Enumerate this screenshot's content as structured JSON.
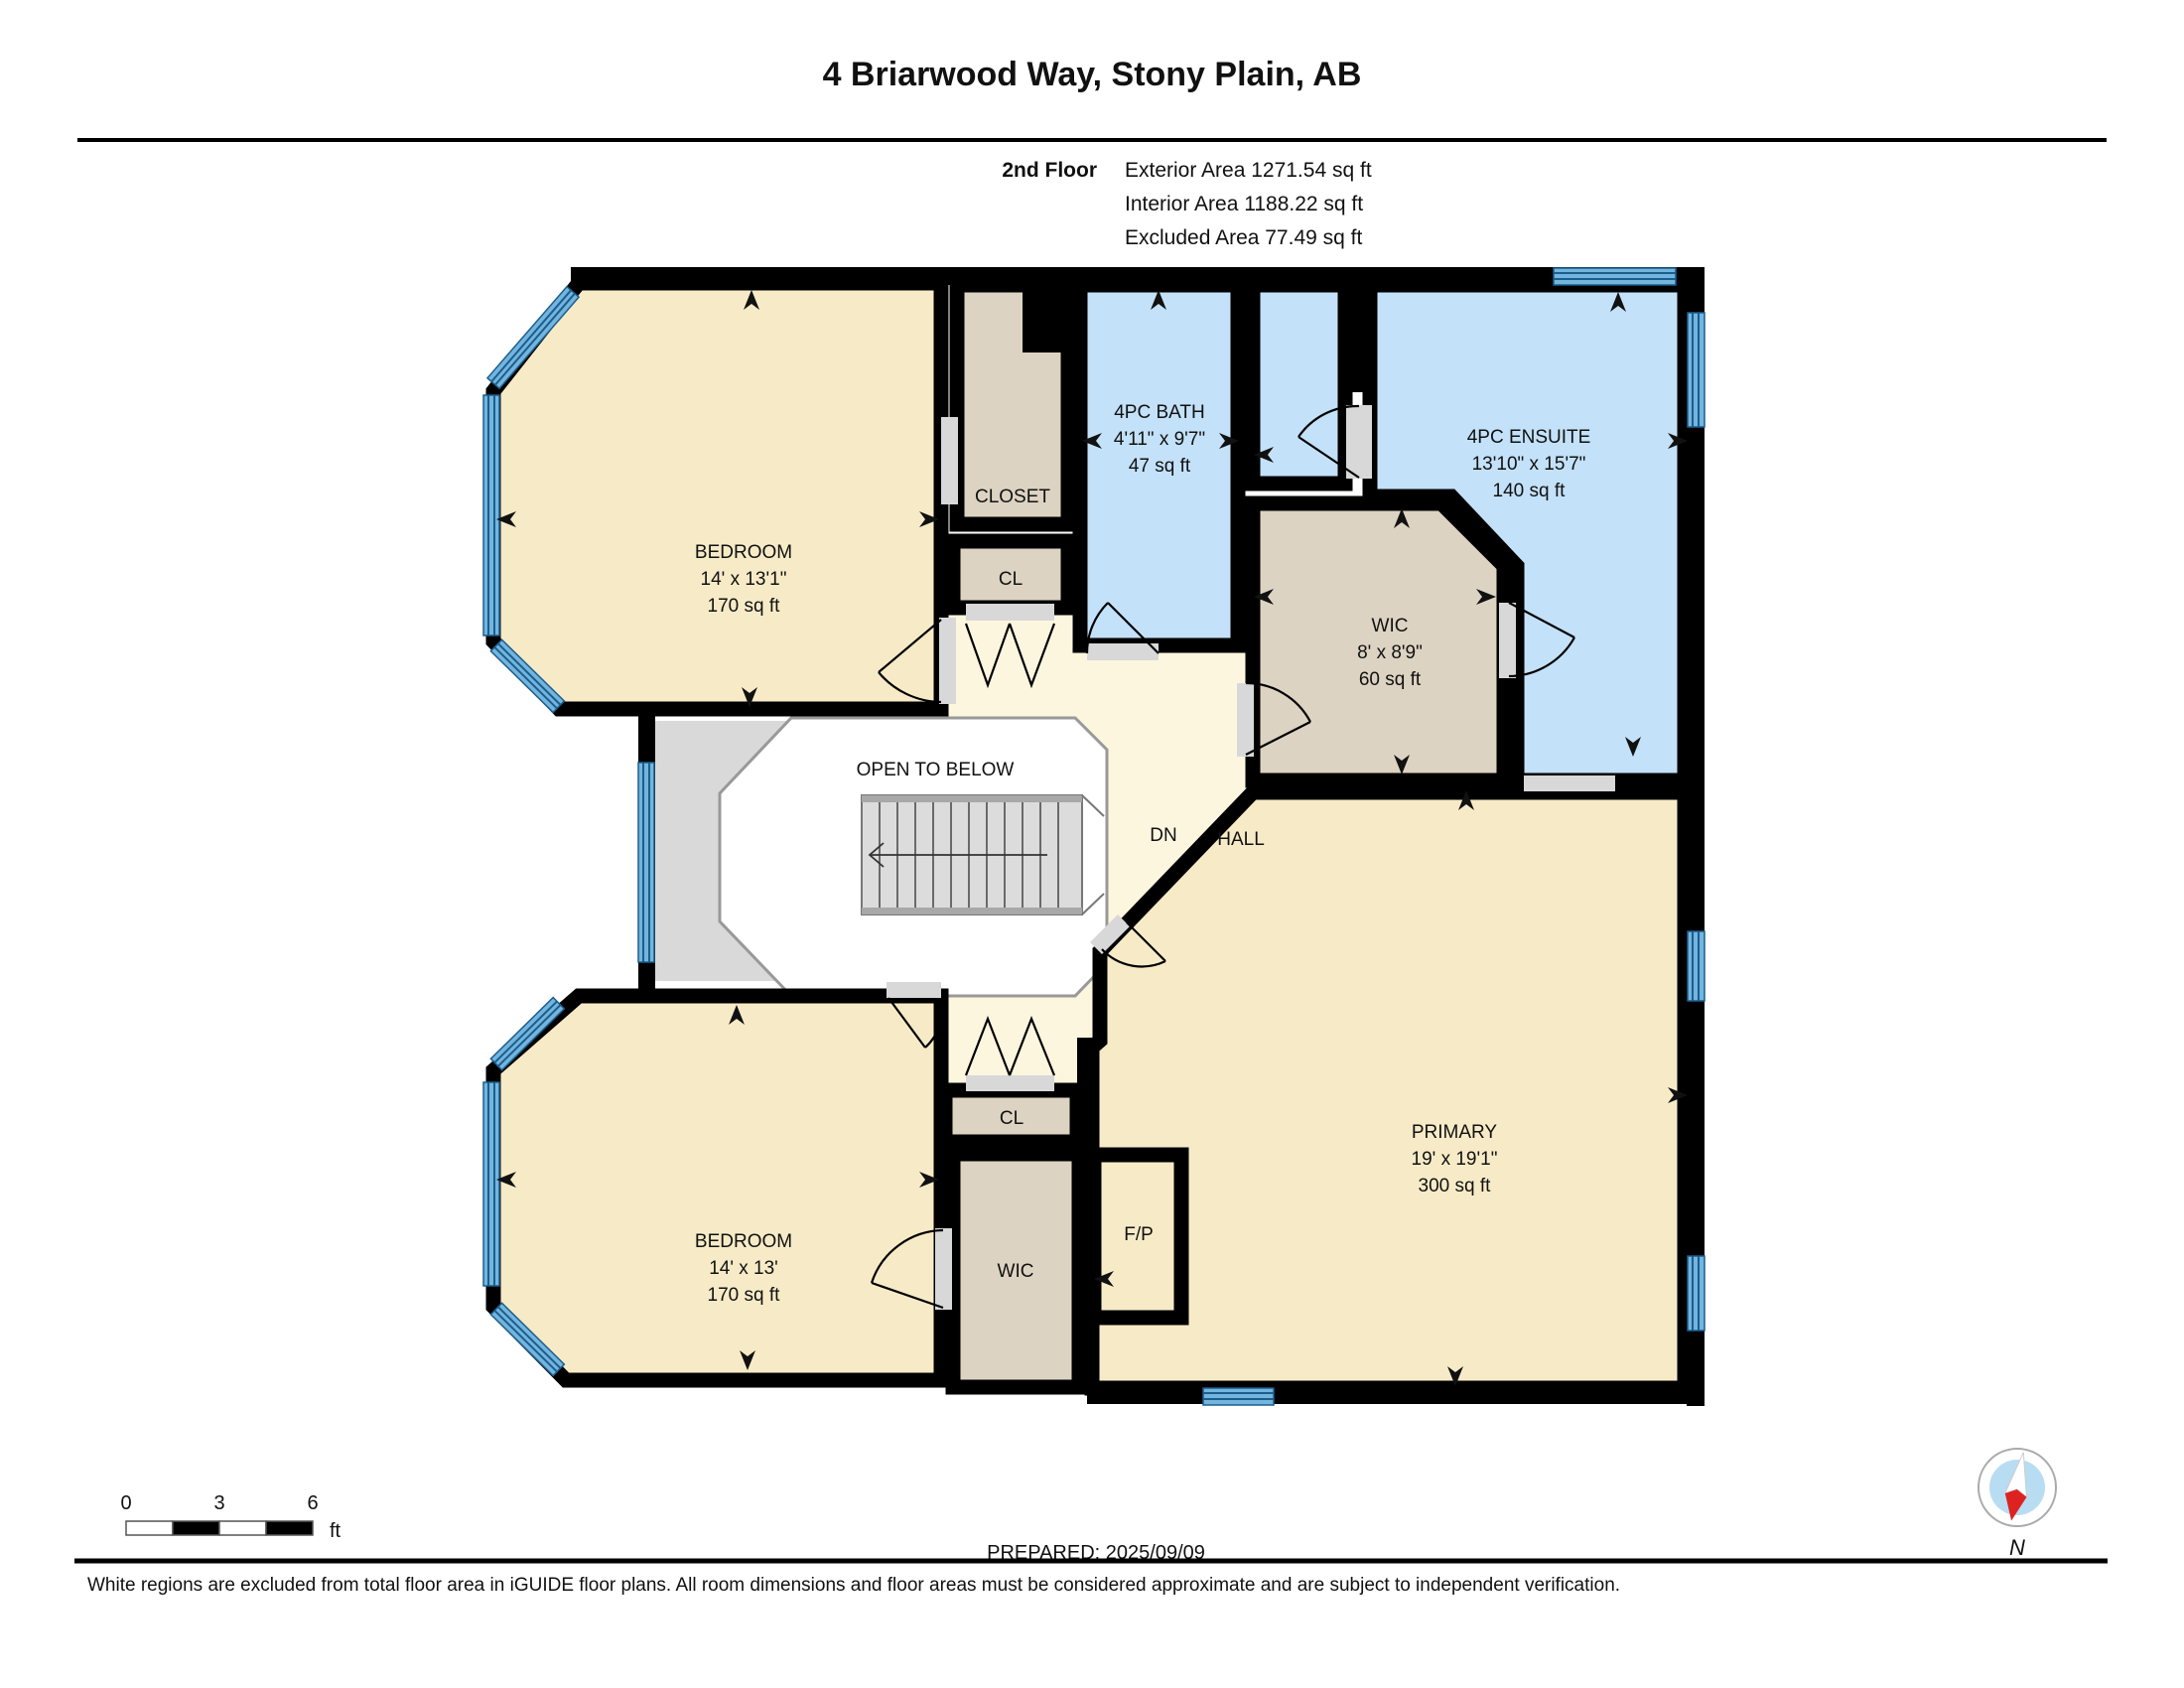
{
  "header": {
    "title": "4 Briarwood Way, Stony Plain, AB",
    "floor_label": "2nd Floor",
    "exterior_area": "Exterior Area 1271.54 sq ft",
    "interior_area": "Interior Area 1188.22 sq ft",
    "excluded_area": "Excluded Area 77.49 sq ft"
  },
  "rooms": {
    "bedroom1": {
      "name": "BEDROOM",
      "dims": "14' x 13'1\"",
      "area": "170 sq ft"
    },
    "closet_upper": {
      "name": "CLOSET"
    },
    "cl_upper": {
      "name": "CL"
    },
    "bath": {
      "name": "4PC BATH",
      "dims": "4'11\" x 9'7\"",
      "area": "47 sq ft"
    },
    "ensuite": {
      "name": "4PC ENSUITE",
      "dims": "13'10\" x 15'7\"",
      "area": "140 sq ft"
    },
    "wic_upper": {
      "name": "WIC",
      "dims": "8' x 8'9\"",
      "area": "60 sq ft"
    },
    "hall": {
      "name": "HALL",
      "stairs": "DN",
      "open_below": "OPEN TO BELOW"
    },
    "bedroom2": {
      "name": "BEDROOM",
      "dims": "14' x 13'",
      "area": "170 sq ft"
    },
    "cl_lower": {
      "name": "CL"
    },
    "wic_lower": {
      "name": "WIC"
    },
    "fireplace": {
      "name": "F/P"
    },
    "primary": {
      "name": "PRIMARY",
      "dims": "19' x 19'1\"",
      "area": "300 sq ft"
    }
  },
  "scale_bar": {
    "tick0": "0",
    "tick3": "3",
    "tick6": "6",
    "unit": "ft"
  },
  "footer": {
    "prepared": "PREPARED: 2025/09/09",
    "compass_north": "N",
    "disclaimer": "White regions are excluded from total floor area in iGUIDE floor plans. All room dimensions and floor areas must be considered approximate and are subject to independent verification."
  },
  "colors": {
    "wall": "#000000",
    "room_cream": "#f7ebc7",
    "hall_cream": "#fdf6df",
    "closet_tan": "#ddd3c2",
    "bath_blue": "#c3e1f8",
    "excluded_gray": "#d9d9d9",
    "window_blue": "#73b5dd",
    "window_line": "#1b5e8e",
    "stairs_gray": "#dcdcdc",
    "door_sill": "#d8d8d8",
    "compass_red": "#dd2222",
    "compass_blue": "#b8ddf2"
  }
}
